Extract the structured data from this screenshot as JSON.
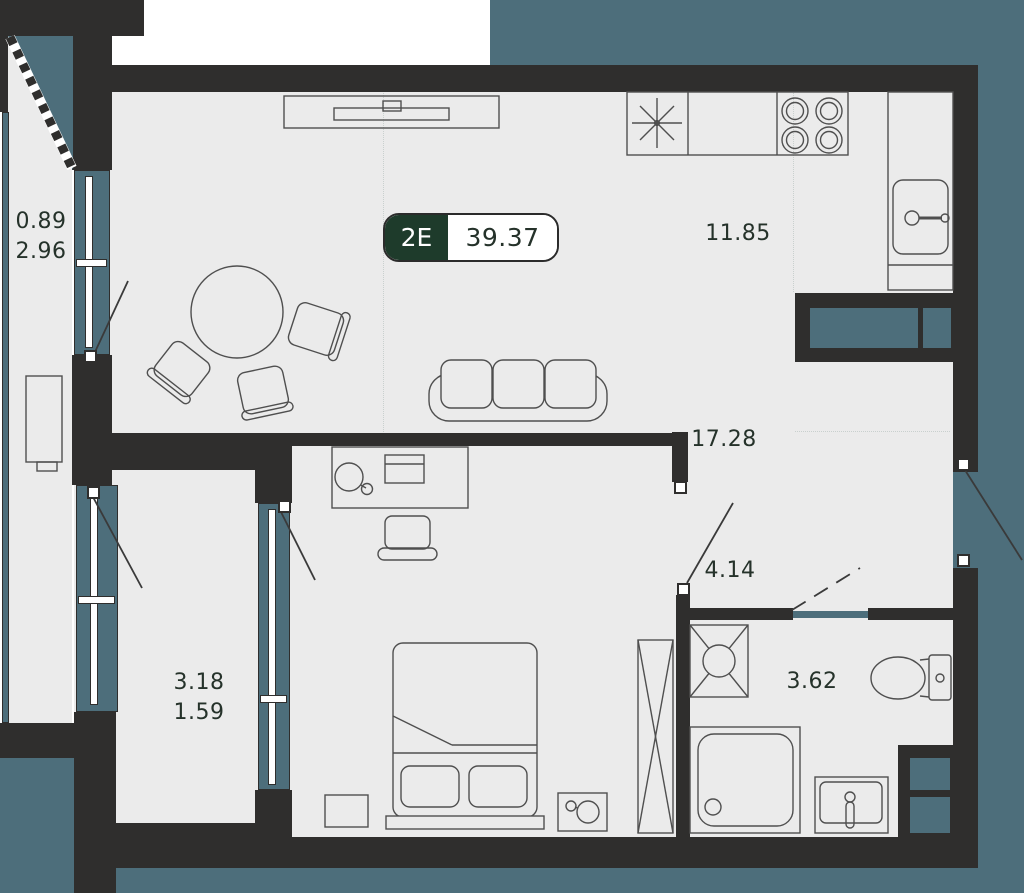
{
  "colors": {
    "wall": "#2f2e2d",
    "glazing": "#4d6e7b",
    "floor": "#ebebeb",
    "ink": "#25322a",
    "badge-green": "#1e3b2b",
    "badge-text": "#ffffff",
    "furniture-stroke": "#4f4f4f",
    "outside": "#ffffff"
  },
  "badge": {
    "type_label": "2E",
    "area_value": "39.37"
  },
  "rooms": {
    "balcony_top": {
      "line1": "0.89",
      "line2": "2.96"
    },
    "kitchen": {
      "area": "11.85"
    },
    "living": {
      "area": "17.28"
    },
    "hallway": {
      "area": "4.14"
    },
    "bathroom": {
      "area": "3.62"
    },
    "balcony_bottom": {
      "line1": "3.18",
      "line2": "1.59"
    }
  },
  "icons": {
    "fridge": "snowflake-asterisk",
    "stove": "four-burner-rings",
    "kitchen_sink": "basin-with-faucet",
    "washing_machine": "square-cross-drum",
    "shower": "tray-with-drain",
    "toilet": "bowl-with-tank",
    "wardrobe": "tall-box-cross",
    "glazing_line": "dashed-diagonal"
  }
}
